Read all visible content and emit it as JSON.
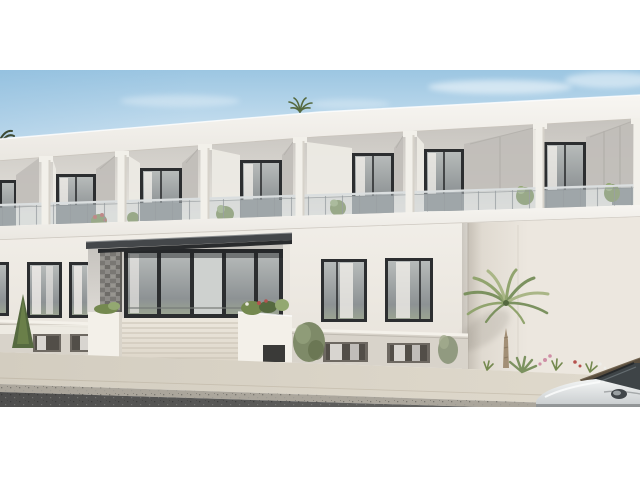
{
  "scene": {
    "type": "exterior-architectural-render",
    "subject": "modern two-storey white apartment building",
    "details": {
      "storeys": 2,
      "balcony_bays_visible": 7,
      "balustrade": "frameless glass with posts",
      "entrance": "recessed glazed lobby with dark flat canopy and wide staircase",
      "stair_steps_visible": 8,
      "vegetation": "palm tree, shrubs, balcony plants, flower bed",
      "street": "sidewalk, curb and asphalt road in foreground",
      "vehicle": "white car partially visible at lower right",
      "framing": "white letterbox bands above and below the render"
    }
  },
  "palette": {
    "letterbox": "#ffffff",
    "sky-top": "#9cc6e2",
    "sky-mid": "#c4ddee",
    "sky-low": "#e7f1f8",
    "cloud": "#ffffff",
    "fascia-hi": "#f8f6f2",
    "fascia-lo": "#e9e6e0",
    "loggia-dark": "#c6c3be",
    "loggia-light": "#e6e3dd",
    "panel-bright": "#eceae4",
    "panel-gray": "#c0bdb8",
    "panel-seam": "#a9a6a1",
    "column": "#f2f0ea",
    "column-shade": "#d6d2ca",
    "frame-dark": "#2c2e30",
    "glass-hi": "#b7bbba",
    "glass-lo": "#8d9294",
    "glass-green": "#9aa392",
    "curtain": "#f0ede9",
    "rail-glass": "#cdd7dc",
    "rail-post": "#9aa0a3",
    "rail-top": "#dadedf",
    "privacy-panel": "#7f8386",
    "slab-hi": "#f6f4f0",
    "slab-lo": "#eae7e1",
    "slab-edge": "#cfcac2",
    "wall-hi": "#f1eee8",
    "wall-lo": "#e7e2da",
    "wing-hi": "#ece7df",
    "wing-lo": "#dcd6cc",
    "plinth": "#d8d3ca",
    "plinth-cap": "#f4f1ea",
    "plinth-frame": "#6e6962",
    "plinth-glass": "#524e48",
    "canopy-face": "#44474a",
    "canopy-under": "#292b2d",
    "stone": "#8d8b87",
    "stone-dark": "#797773",
    "lobby-door-glass": "#ced1cf",
    "steps-hi": "#ece7dd",
    "steps-lo": "#ddd6c9",
    "steps-line": "#c8c1b3",
    "planter": "#f3f0e9",
    "foliage-dark": "#55693f",
    "foliage-mid": "#74894f",
    "foliage-light": "#93a871",
    "flower-red": "#b5524e",
    "flower-pink": "#cf8fa6",
    "palm-frond-a": "#91a46e",
    "palm-frond-b": "#7c9260",
    "palm-frond-c": "#aab687",
    "palm-trunk": "#a28f76",
    "sidewalk-hi": "#e0dacd",
    "sidewalk-lo": "#d3cdc0",
    "curb": "#aba69c",
    "asphalt-a": "#4e4e4d",
    "asphalt-b": "#6b6b69",
    "car-body-hi": "#f3f5f5",
    "car-body-lo": "#c7cbcd",
    "car-glass": "#3e4447",
    "car-rail": "#5a4e3e",
    "shadow-soft": "#5a554b"
  }
}
